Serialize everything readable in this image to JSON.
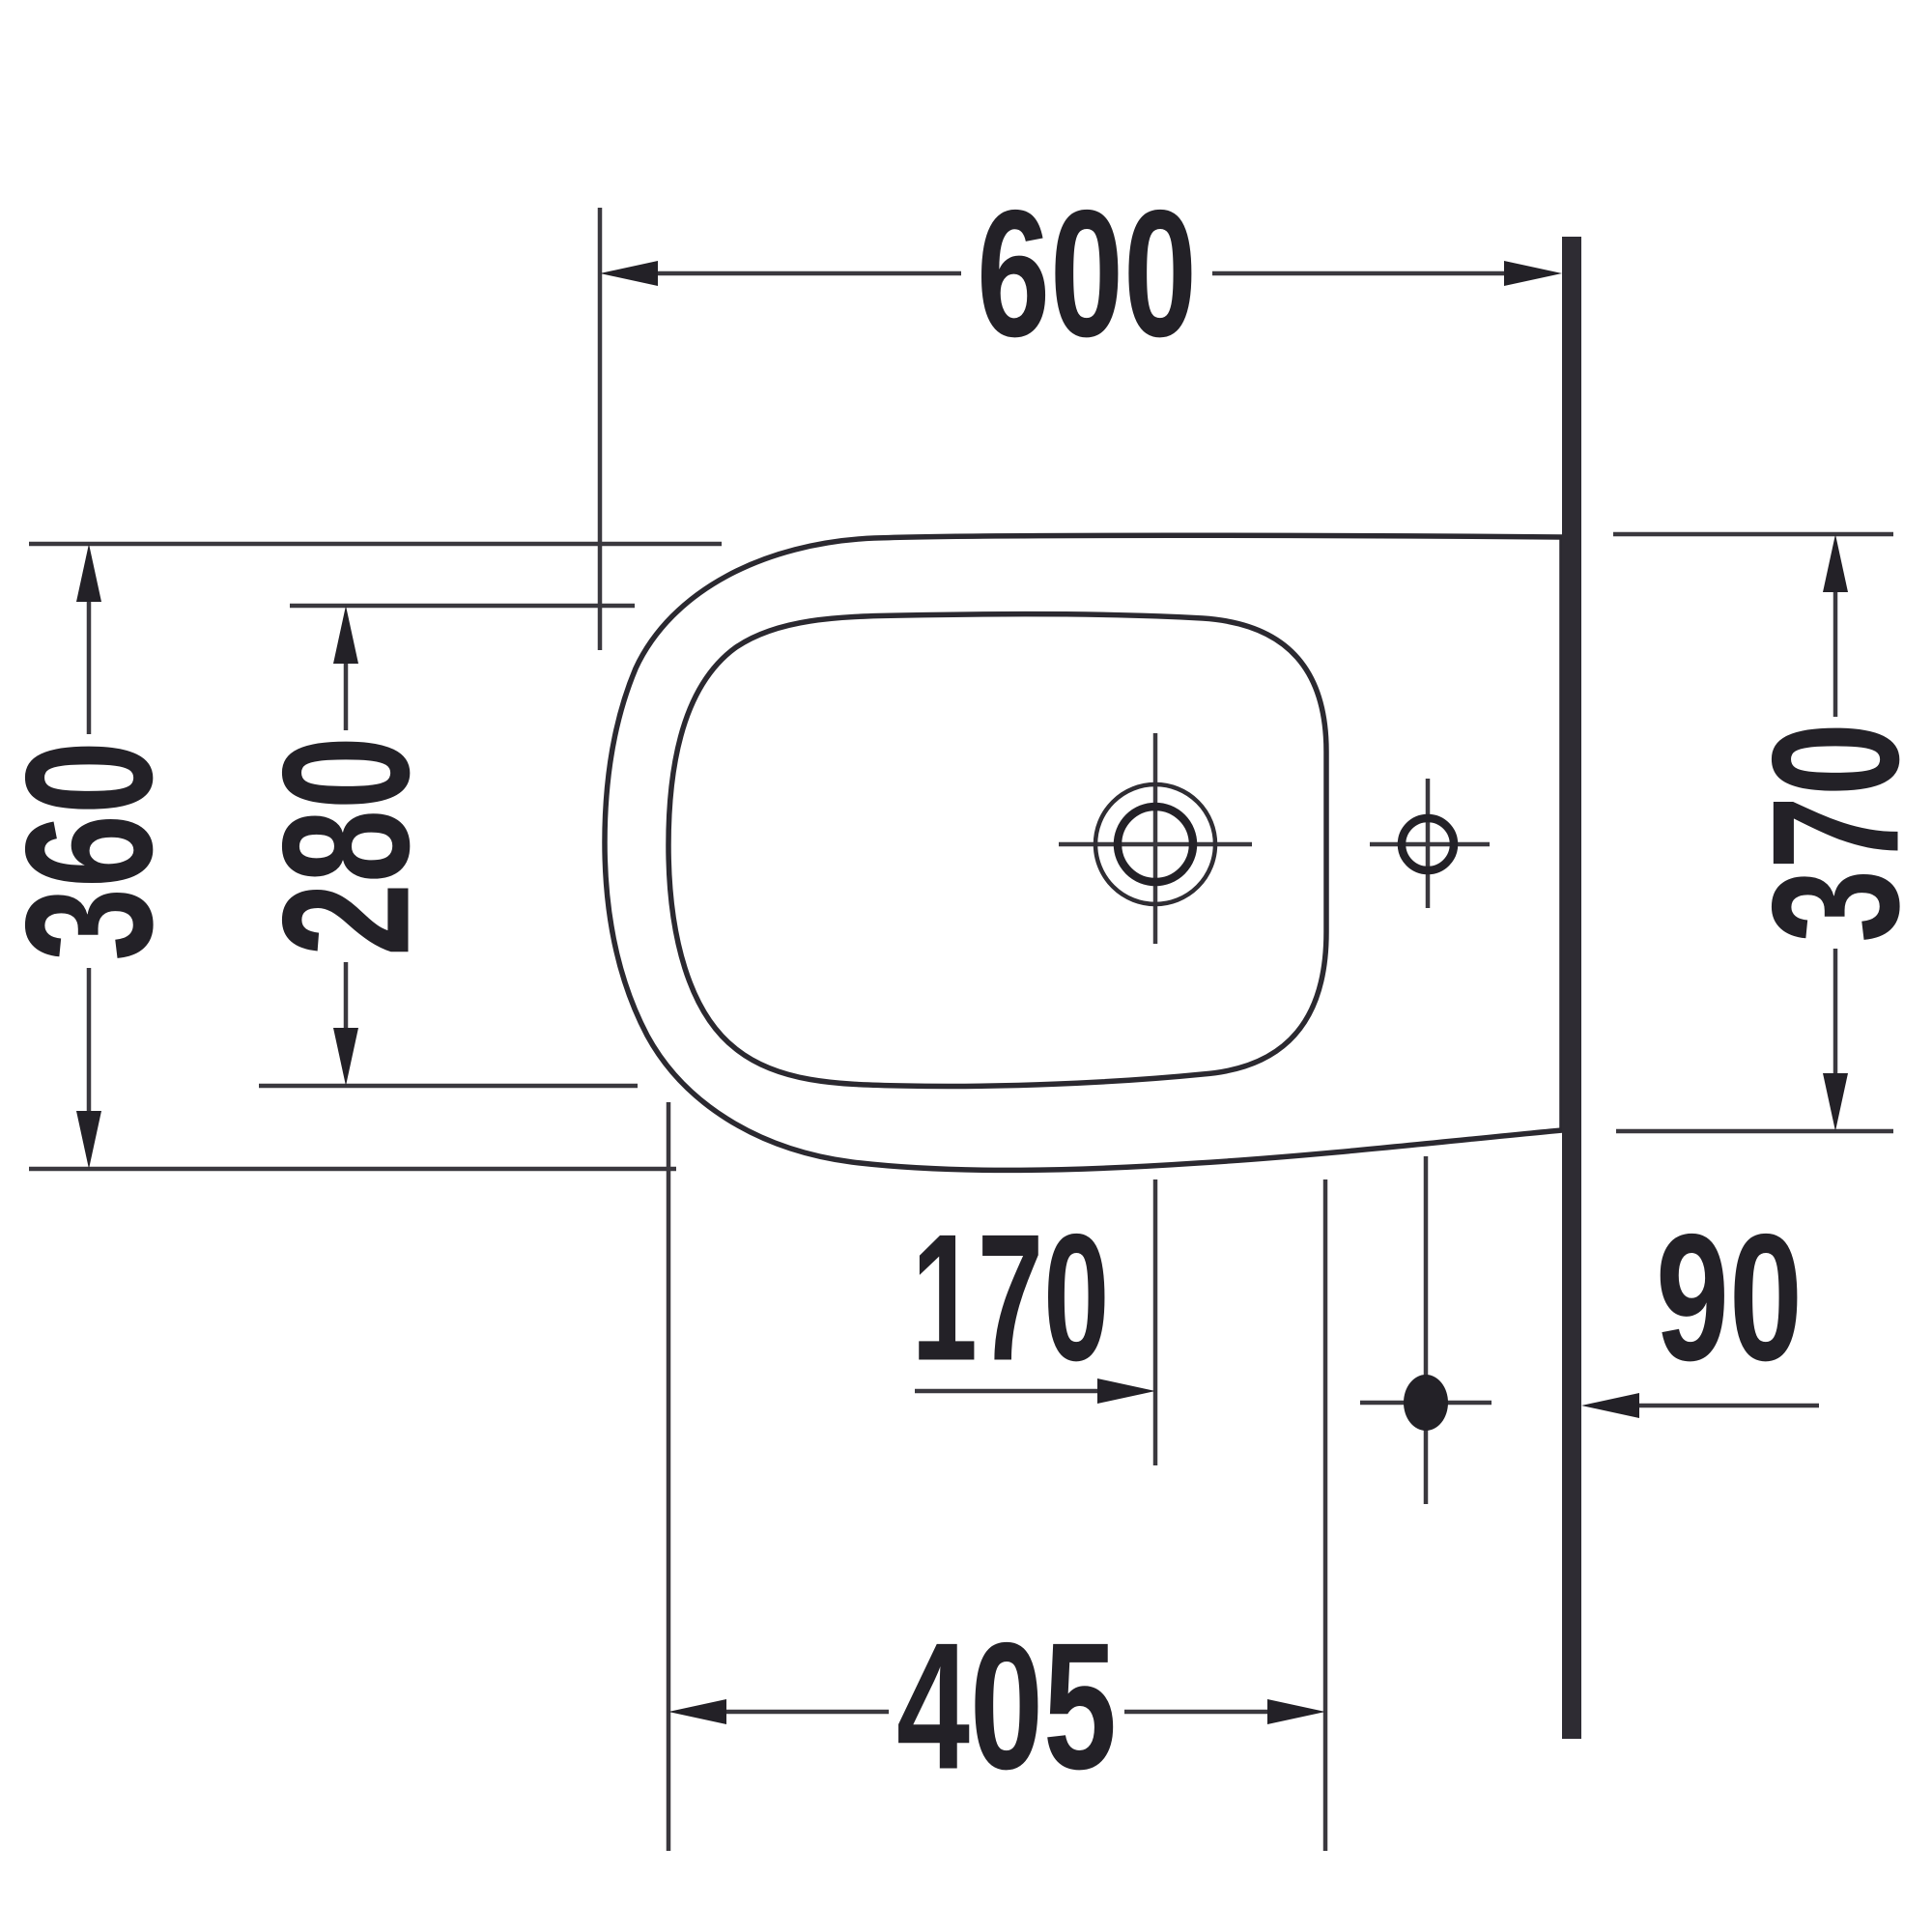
{
  "drawing": {
    "kind": "bidet-top-view-dimension-drawing",
    "units_implied": "mm",
    "dims": {
      "depth": "600",
      "front_width": "360",
      "bowl_width": "280",
      "wall_width": "370",
      "faucet_to_drain": "170",
      "wall_to_drain": "90",
      "bowl_length": "405"
    },
    "colors": {
      "background": "#ffffff",
      "line": "#3a383e",
      "ink": "#232127",
      "wall": "#2e2c33"
    }
  }
}
